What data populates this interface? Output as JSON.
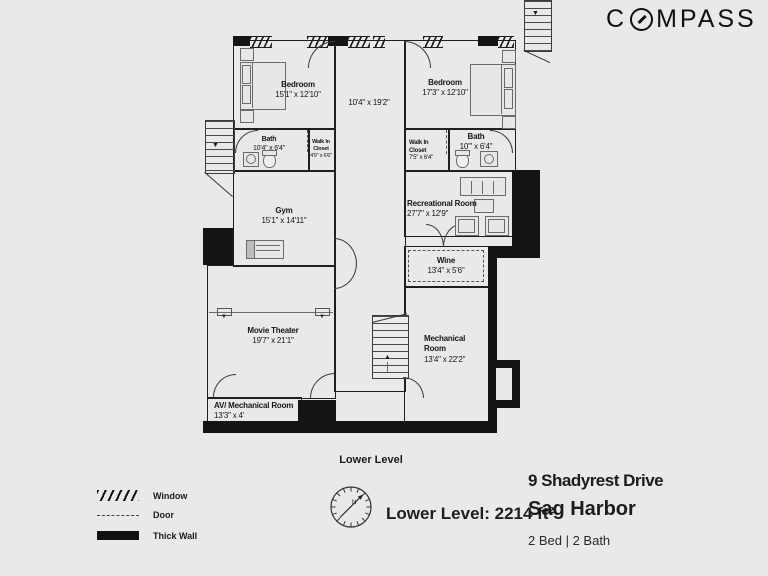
{
  "brand": {
    "name": "COMPASS"
  },
  "plan": {
    "caption": "Lower Level",
    "rooms": {
      "bedroom_left": {
        "name": "Bedroom",
        "dims": "15'1\" x 12'10\""
      },
      "bedroom_right": {
        "name": "Bedroom",
        "dims": "17'3\" x 12'10\""
      },
      "hallway": {
        "dims": "10'4\" x 19'2\""
      },
      "bath_left": {
        "name": "Bath",
        "dims": "10'4\" x 6'4\""
      },
      "closet_left": {
        "name": "Walk In Closet",
        "dims": "4'9\" x 6'6\""
      },
      "closet_right": {
        "name": "Walk In Closet",
        "dims": "7'5\" x 6'4\""
      },
      "bath_right": {
        "name": "Bath",
        "dims": "10'\" x 6'4\""
      },
      "gym": {
        "name": "Gym",
        "dims": "15'1\" x 14'11\""
      },
      "recreational": {
        "name": "Recreational Room",
        "dims": "27'7\" x 12'9\""
      },
      "wine": {
        "name": "Wine",
        "dims": "13'4\" x 5'6\""
      },
      "movie_theater": {
        "name": "Movie Theater",
        "dims": "19'7\" x 21'1\""
      },
      "mechanical": {
        "name": "Mechanical Room",
        "dims": "13'4\" x 22'2\""
      },
      "av_mechanical": {
        "name": "AV/ Mechanical Room",
        "dims": "13'3\" x 4'"
      }
    }
  },
  "legend": {
    "window": "Window",
    "door": "Door",
    "thick_wall": "Thick Wall"
  },
  "footer": {
    "area": "Lower Level: 2214 ft²",
    "north": "N"
  },
  "listing": {
    "address": "9 Shadyrest Drive",
    "city": "Sag Harbor",
    "beds_baths": "2 Bed | 2 Bath"
  },
  "colors": {
    "background": "#e9e9e9",
    "wall": "#161616",
    "text": "#1c1c1c"
  }
}
